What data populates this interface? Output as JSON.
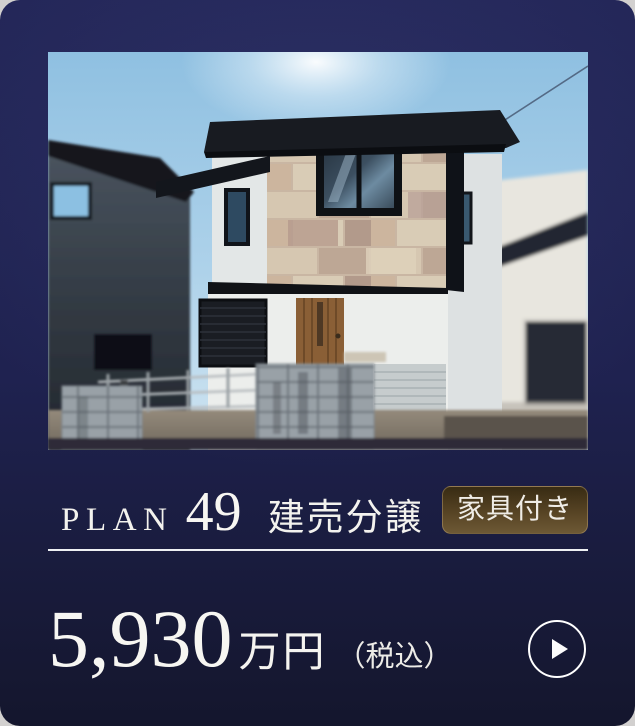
{
  "plan": {
    "label": "PLAN",
    "number": "49",
    "category": "建売分譲",
    "badge": "家具付き"
  },
  "price": {
    "amount": "5,930",
    "unit": "万円",
    "tax_note": "（税込）"
  },
  "action": {
    "icon": "play-arrow"
  },
  "colors": {
    "card_top": "#242759",
    "card_bottom": "#14162d",
    "badge_top": "#382b13",
    "badge_bottom": "#6d5835",
    "text": "#f5f4f1",
    "divider": "#eef0f3"
  }
}
